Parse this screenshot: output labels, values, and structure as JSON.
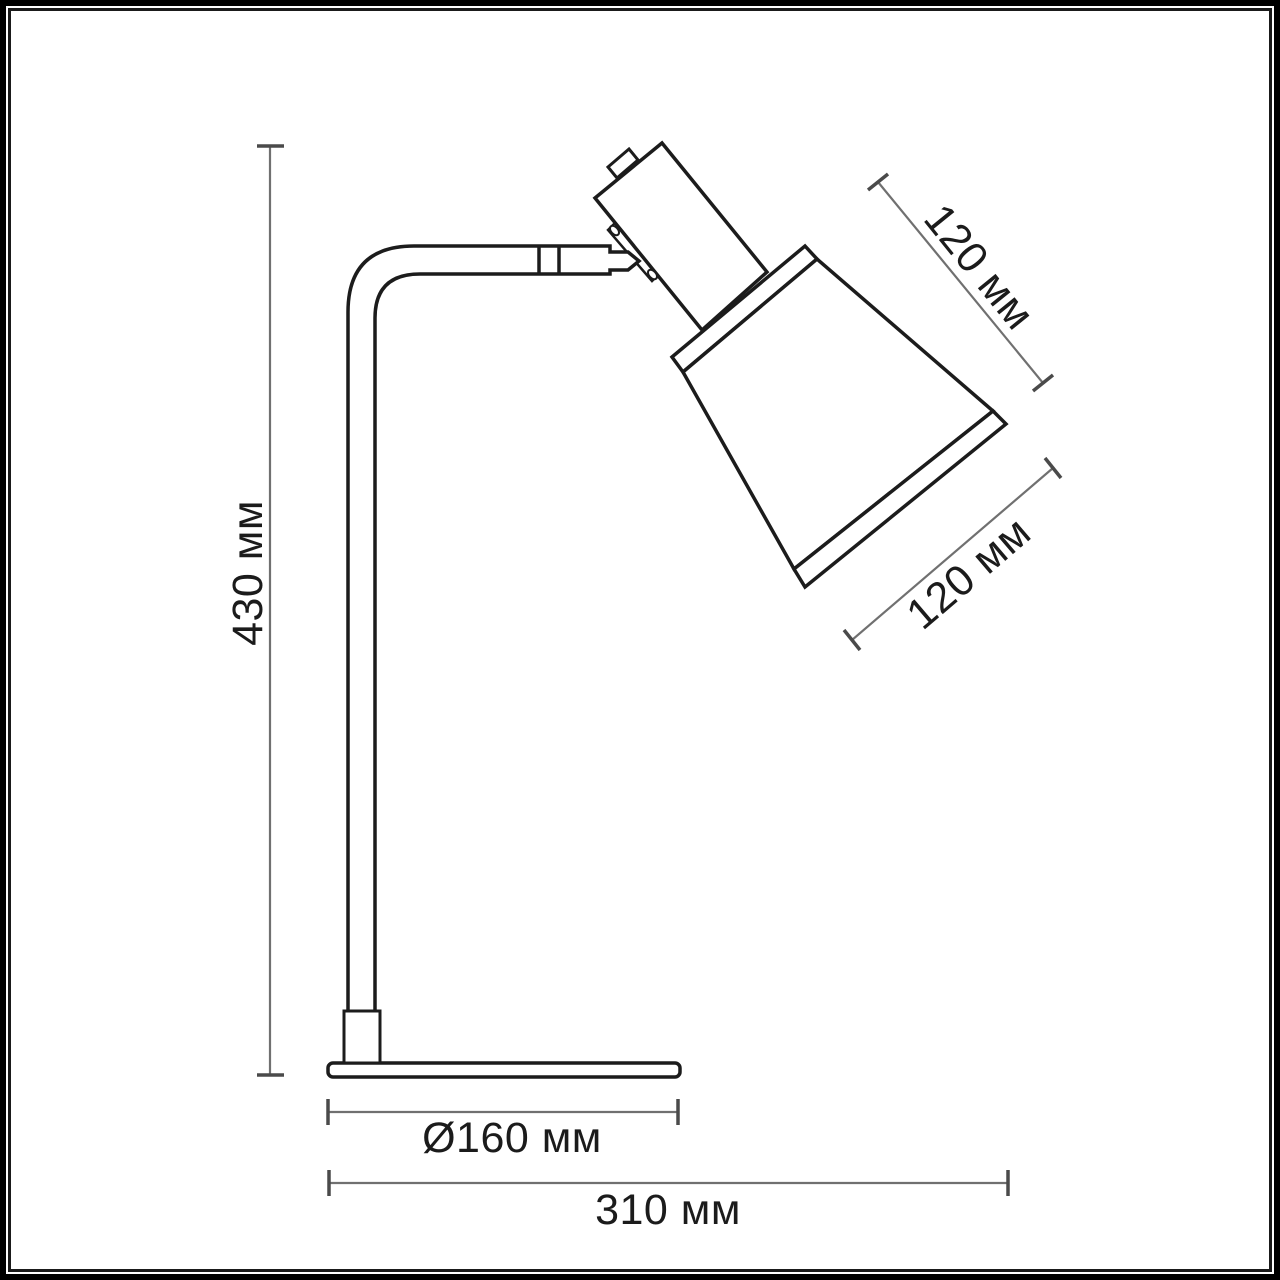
{
  "drawing": {
    "subject": "desk-lamp-technical-drawing",
    "colors": {
      "background": "#ffffff",
      "outline": "#1c1c1c",
      "dimension_line": "#707070",
      "dimension_tick": "#4a4a4a",
      "text": "#1b1b1b",
      "frame": "#000000"
    }
  },
  "dimension_labels": {
    "height": "430 мм",
    "shade_side": "120 мм",
    "shade_opening": "120 мм",
    "base_diameter": "Ø160 мм",
    "overall_depth": "310 мм"
  }
}
